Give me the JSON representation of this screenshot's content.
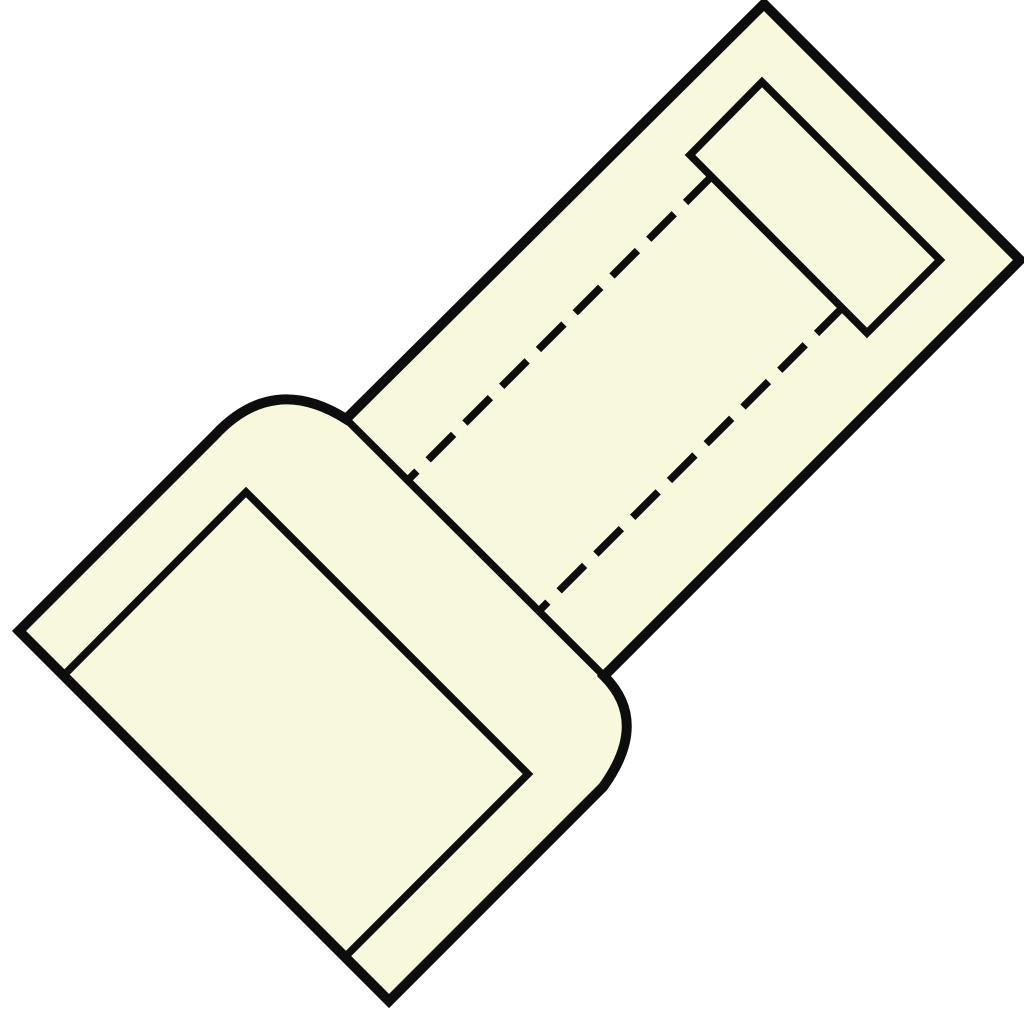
{
  "meta": {
    "alt_text": "Technical line drawing of an insulated butt crimp connector shown rotated 45 degrees, with pale yellow body, thick black outline, bell-mouth transition bumps, inner crimp barrel rectangle, dashed hidden bore lines and inner sleeve wall lines"
  },
  "drawing": {
    "canvas": {
      "width": 1024,
      "height": 1024
    },
    "colors": {
      "background": "#ffffff",
      "body_fill": "#f8f8dc",
      "line": "#0d0d0d"
    },
    "strokes": {
      "outline_width": 10,
      "inner_width": 7.5,
      "dash_pattern": "36 16"
    },
    "shapes": [
      {
        "name": "connector-body-outline",
        "d": "M 764,4 L 1020,260 L 604,676 Q 650,722 603,787 L 389,1001 L 19,631 L 215,435 Q 273,373 346,419 Z",
        "fill": "body_fill",
        "stroke": "line",
        "width": "outline_width",
        "dashed": false
      },
      {
        "name": "crimp-barrel-rect",
        "d": "M 690,155 L 762,82 L 940,260 L 867,333 Z",
        "fill": "none",
        "stroke": "line",
        "width": "inner_width",
        "dashed": false
      },
      {
        "name": "sleeve-mouth-edge-line",
        "d": "M 346,419 L 604,676",
        "fill": "none",
        "stroke": "line",
        "width": "inner_width",
        "dashed": false
      },
      {
        "name": "sleeve-inner-wall-line",
        "d": "M 63,676 L 246,492 L 528,774 L 345,957",
        "fill": "none",
        "stroke": "line",
        "width": "inner_width",
        "dashed": false
      },
      {
        "name": "bore-hidden-line-upper",
        "d": "M 711,177 L 408,480",
        "fill": "none",
        "stroke": "line",
        "width": "inner_width",
        "dashed": true
      },
      {
        "name": "bore-hidden-line-lower",
        "d": "M 842,308 L 539,611",
        "fill": "none",
        "stroke": "line",
        "width": "inner_width",
        "dashed": true
      }
    ]
  }
}
